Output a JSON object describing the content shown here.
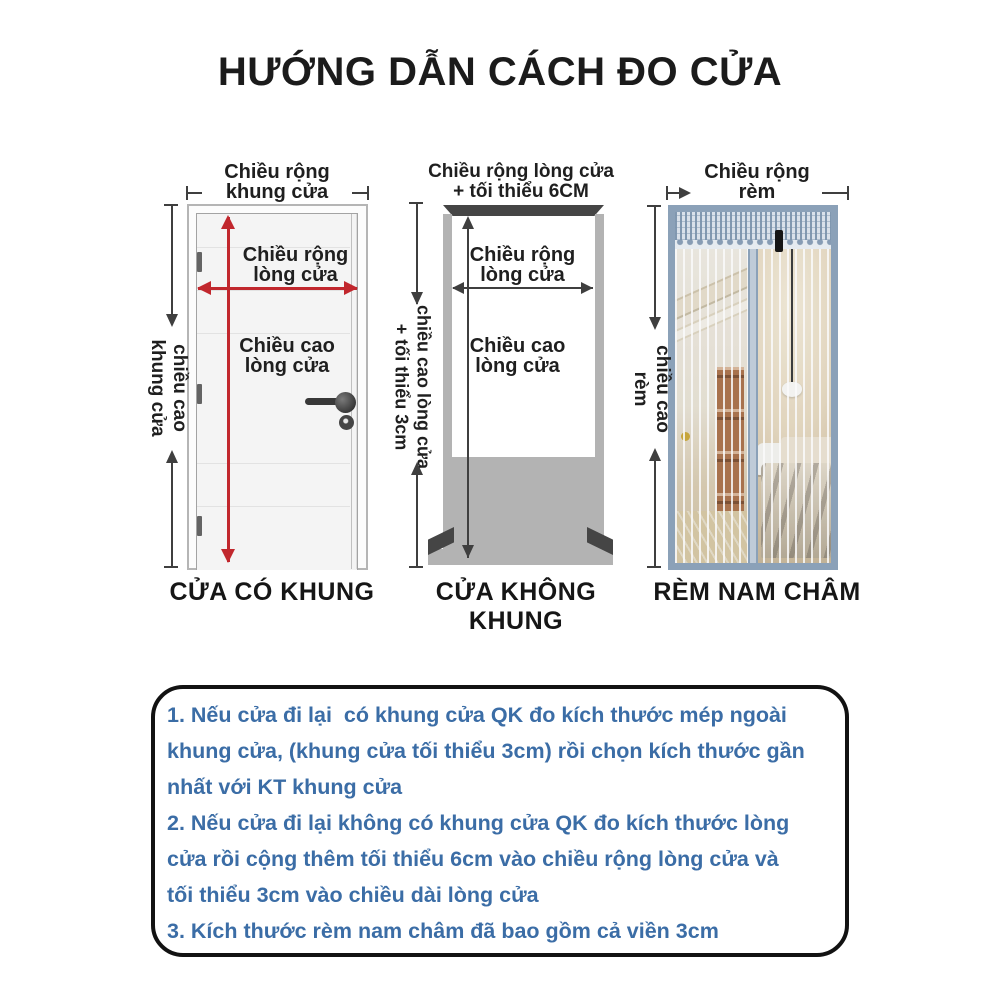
{
  "title": "HƯỚNG DẪN CÁCH ĐO CỬA",
  "colors": {
    "accent_red": "#c1272d",
    "instruction_blue": "#3b6da6",
    "dimension_gray": "#3f3f3f",
    "curtain_frame_blue": "#8ba1b8"
  },
  "diagrams": {
    "framed_door": {
      "caption": "CỬA CÓ KHUNG",
      "top_width": {
        "line1": "Chiều rộng",
        "line2": "khung cửa"
      },
      "side_height": {
        "line1": "chiều cao",
        "line2": "khung cửa"
      },
      "inner_width": {
        "line1": "Chiều rộng",
        "line2": "lòng cửa"
      },
      "inner_height": {
        "line1": "Chiều cao",
        "line2": "lòng cửa"
      }
    },
    "frameless_door": {
      "caption": "CỬA KHÔNG KHUNG",
      "top_width": {
        "line1": "Chiều rộng lòng cửa",
        "line2": "+ tối thiểu 6CM"
      },
      "side_height": {
        "line1": "chiều cao lòng cửa",
        "line2": "+ tối thiểu 3cm"
      },
      "inner_width": {
        "line1": "Chiều rộng",
        "line2": "lòng cửa"
      },
      "inner_height": {
        "line1": "Chiều cao",
        "line2": "lòng cửa"
      }
    },
    "curtain": {
      "caption": "RÈM NAM CHÂM",
      "top_width": {
        "line1": "Chiều rộng",
        "line2": "rèm"
      },
      "side_height": {
        "line1": "chiều cao",
        "line2": "rèm"
      }
    }
  },
  "instructions": {
    "lines": [
      "1. Nếu cửa đi lại  có khung cửa QK đo kích thước mép ngoài",
      "khung cửa, (khung cửa tối thiểu 3cm) rồi chọn kích thước gần",
      "nhất với KT khung cửa",
      "2. Nếu cửa đi lại không có khung cửa QK đo kích thước lòng",
      "cửa rồi cộng thêm tối thiểu 6cm vào chiều rộng lòng cửa và",
      "tối thiểu 3cm vào chiều dài lòng cửa",
      "3. Kích thước rèm nam châm đã bao gồm cả viền 3cm"
    ]
  }
}
